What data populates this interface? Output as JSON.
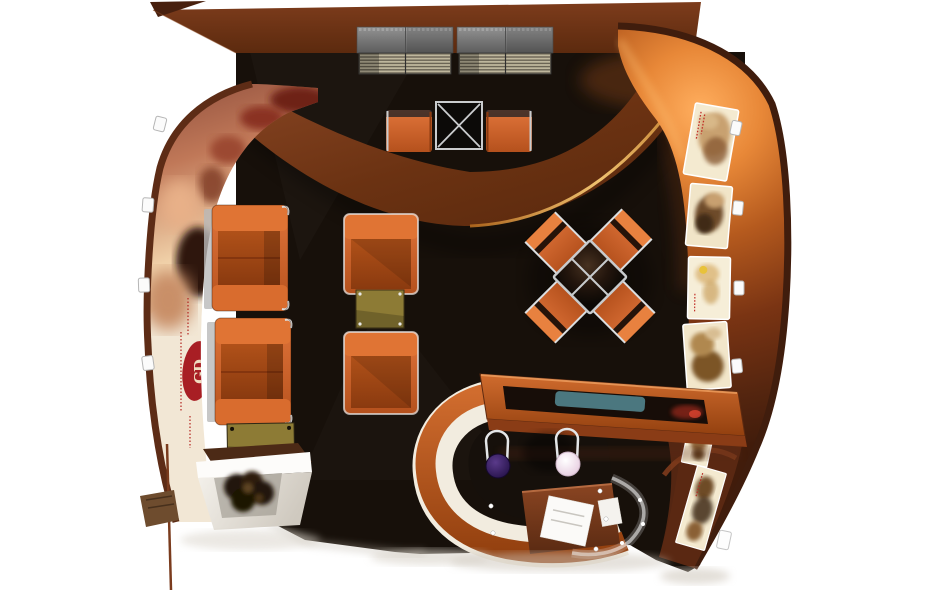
{
  "scene": {
    "title": "Exhibition booth 3D render - top view",
    "type": "architectural-render",
    "logo": {
      "monogram": "GD"
    },
    "colors": {
      "background": "#ffffff",
      "floor": "#17100a",
      "fascia_brown": "#6f3315",
      "swoosh_brown": "#7c3a18",
      "copper_bright": "#e89040",
      "copper_dark": "#4a2110",
      "sofa_orange": "#d2602a",
      "seat_orange_dark": "#9e4415",
      "table_gold": "#8d7b35",
      "teal_glass": "#4e7d86",
      "stool_purple": "#2f1b53",
      "stool_white": "#f7eef5",
      "counter_white": "#f2ecdf",
      "cabinet_gray": "#7f7f7f",
      "louver_beige": "#b4ac92",
      "chrome": "#d5d8da",
      "logo_red": "#a81e24",
      "mural_cream": "#f2e7d5"
    },
    "objects": [
      {
        "name": "top-fascia",
        "desc": "brown canopy band across the top"
      },
      {
        "name": "curved-swoosh",
        "desc": "suspended curved brown beam with gold rim light"
      },
      {
        "name": "left-wall",
        "desc": "curved wall with sepia mural, red logo and clip lights"
      },
      {
        "name": "right-wall",
        "desc": "glowing copper curved wall with sepia poster panels"
      },
      {
        "name": "louver-cabinets",
        "desc": "two grey slatted storage cabinets"
      },
      {
        "name": "top-table-set",
        "desc": "square glass table flanked by two orange chairs"
      },
      {
        "name": "sofa-row",
        "desc": "two orange sofa modules, gold coffee table and white planter"
      },
      {
        "name": "lounge-pair",
        "desc": "two orange armchairs facing across a gold side table"
      },
      {
        "name": "x-seating-group",
        "desc": "four orange chairs around a diamond glass table"
      },
      {
        "name": "display-case",
        "desc": "copper framed showcase with teal glass insert"
      },
      {
        "name": "reception-counter",
        "desc": "U-shaped copper/white counter, two bar stools, desk and curved glass screen"
      }
    ]
  }
}
